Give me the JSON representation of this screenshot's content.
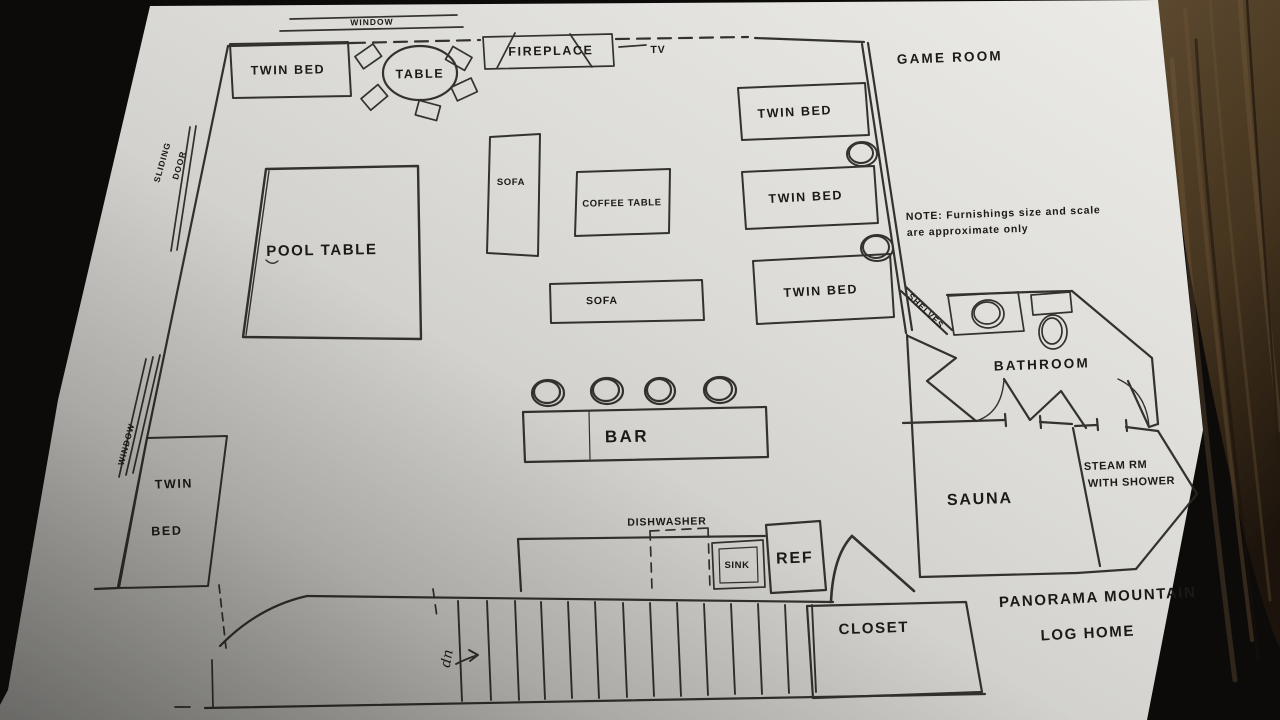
{
  "colors": {
    "paper": "#e0dfdb",
    "ink": "#1c1a17",
    "mat": "#0d0b09",
    "wood": "#4c3a24"
  },
  "rooms": {
    "game_room": "GAME ROOM",
    "bathroom": "BATHROOM",
    "sauna": "SAUNA",
    "steam_room_line1": "STEAM RM",
    "steam_room_line2": "WITH SHOWER",
    "closet": "CLOSET"
  },
  "furniture": {
    "twin_bed_top_left": "TWIN BED",
    "table": "TABLE",
    "fireplace": "FIREPLACE",
    "tv": "TV",
    "pool_table": "POOL TABLE",
    "sofa_vertical": "SOFA",
    "coffee_table": "COFFEE TABLE",
    "sofa_horizontal": "SOFA",
    "twin_bed_right_1": "TWIN BED",
    "twin_bed_right_2": "TWIN BED",
    "twin_bed_right_3": "TWIN BED",
    "bar": "BAR",
    "shelves": "SHELVES",
    "twin_bed_bottom_left_line1": "TWIN",
    "twin_bed_bottom_left_line2": "BED",
    "dishwasher": "DISHWASHER",
    "sink": "SINK",
    "refrigerator": "REF"
  },
  "openings": {
    "window_top": "WINDOW",
    "window_left": "WINDOW",
    "sliding_door_line1": "SLIDING",
    "sliding_door_line2": "DOOR",
    "stairs_direction": "up"
  },
  "annotations": {
    "note_line1": "NOTE: Furnishings size and scale",
    "note_line2": "are approximate only",
    "home_name_line1": "PANORAMA MOUNTAIN",
    "home_name_line2": "LOG HOME"
  }
}
